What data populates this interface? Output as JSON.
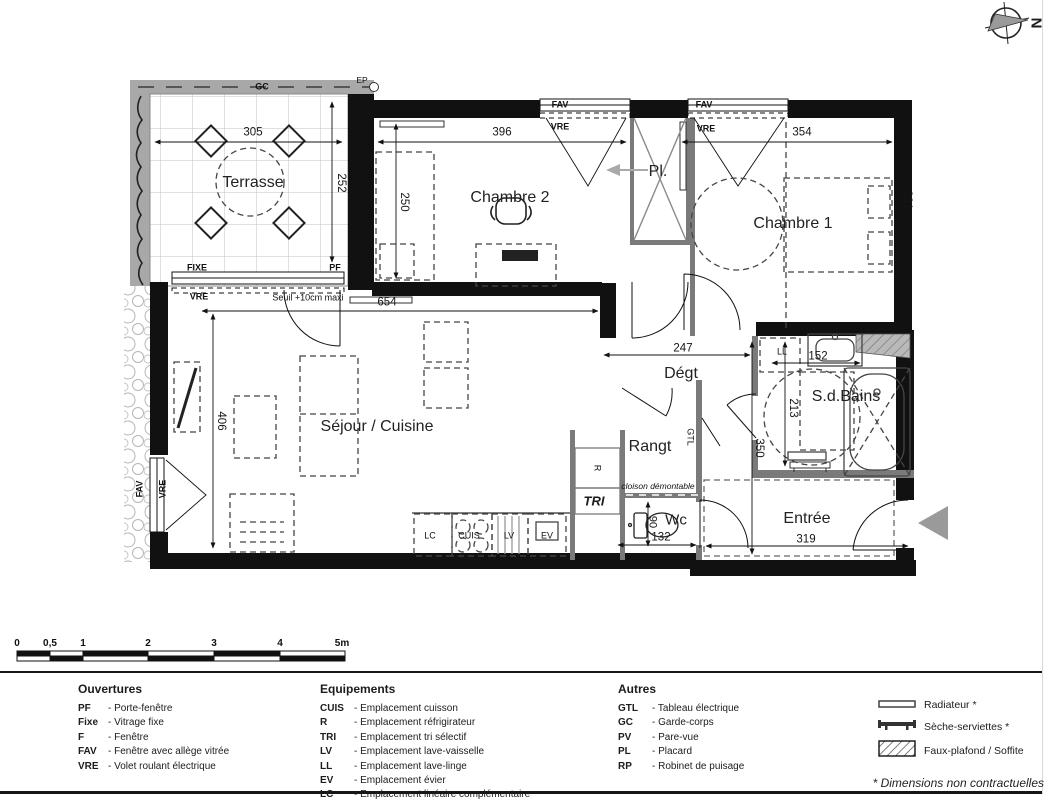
{
  "compass": {
    "north": "N"
  },
  "plan": {
    "labels": {
      "terrasse": "Terrasse",
      "chambre2": "Chambre 2",
      "chambre1": "Chambre 1",
      "placard": "Pl.",
      "sejour": "Séjour / Cuisine",
      "degt": "Dégt",
      "sdb": "S.d.Bains",
      "rangt": "Rangt",
      "wc": "Wc",
      "entree": "Entrée"
    },
    "dims": {
      "d305": "305",
      "d252": "252",
      "d396": "396",
      "d250": "250",
      "d354": "354",
      "d321": "321",
      "d654": "654",
      "d406": "406",
      "d247": "247",
      "d152": "152",
      "d213": "213",
      "d350": "350",
      "d90": "90",
      "d132": "132",
      "d319": "319"
    },
    "ann": {
      "gc": "GC",
      "ep": "EP",
      "fixe": "FIXE",
      "pf": "PF",
      "fav": "FAV",
      "vre": "VRE",
      "seuil": "Seuil +10cm maxi",
      "ll": "LL",
      "gtl": "GTL",
      "cloison": "cloison démontable",
      "r": "R",
      "tri": "TRI",
      "lc": "LC",
      "cuis": "CUIS",
      "lv": "LV",
      "ev": "EV"
    }
  },
  "scalebar": {
    "labels": [
      "0",
      "0,5",
      "1",
      "2",
      "3",
      "4",
      "5m"
    ]
  },
  "legend": {
    "columns": [
      {
        "title": "Ouvertures",
        "items": [
          {
            "abbr": "PF",
            "desc": "- Porte-fenêtre"
          },
          {
            "abbr": "Fixe",
            "desc": "- Vitrage fixe"
          },
          {
            "abbr": "F",
            "desc": "- Fenêtre"
          },
          {
            "abbr": "FAV",
            "desc": "- Fenêtre avec allège vitrée"
          },
          {
            "abbr": "VRE",
            "desc": "- Volet roulant électrique"
          }
        ]
      },
      {
        "title": "Equipements",
        "items": [
          {
            "abbr": "CUIS",
            "desc": "- Emplacement cuisson"
          },
          {
            "abbr": "R",
            "desc": "- Emplacement réfrigirateur"
          },
          {
            "abbr": "TRI",
            "desc": "- Emplacement tri sélectif"
          },
          {
            "abbr": "LV",
            "desc": "- Emplacement lave-vaisselle"
          },
          {
            "abbr": "LL",
            "desc": "- Emplacement lave-linge"
          },
          {
            "abbr": "EV",
            "desc": "- Emplacement évier"
          },
          {
            "abbr": "LC",
            "desc": "- Emplacement linéaire complémentaire"
          }
        ]
      },
      {
        "title": "Autres",
        "items": [
          {
            "abbr": "GTL",
            "desc": "- Tableau électrique"
          },
          {
            "abbr": "GC",
            "desc": "- Garde-corps"
          },
          {
            "abbr": "PV",
            "desc": "- Pare-vue"
          },
          {
            "abbr": "PL",
            "desc": "- Placard"
          },
          {
            "abbr": "RP",
            "desc": "- Robinet de puisage"
          }
        ]
      }
    ],
    "symbols": [
      {
        "icon": "radiator-icon",
        "label": "Radiateur *"
      },
      {
        "icon": "towel-dryer-icon",
        "label": "Sèche-serviettes *"
      },
      {
        "icon": "false-ceiling-icon",
        "label": "Faux-plafond / Soffite"
      }
    ],
    "footnote": "* Dimensions non contractuelles"
  },
  "colors": {
    "wall": "#111111",
    "partition": "#7a7a7a",
    "band": "#a8a8a8",
    "arrow": "#9a9a9a"
  }
}
